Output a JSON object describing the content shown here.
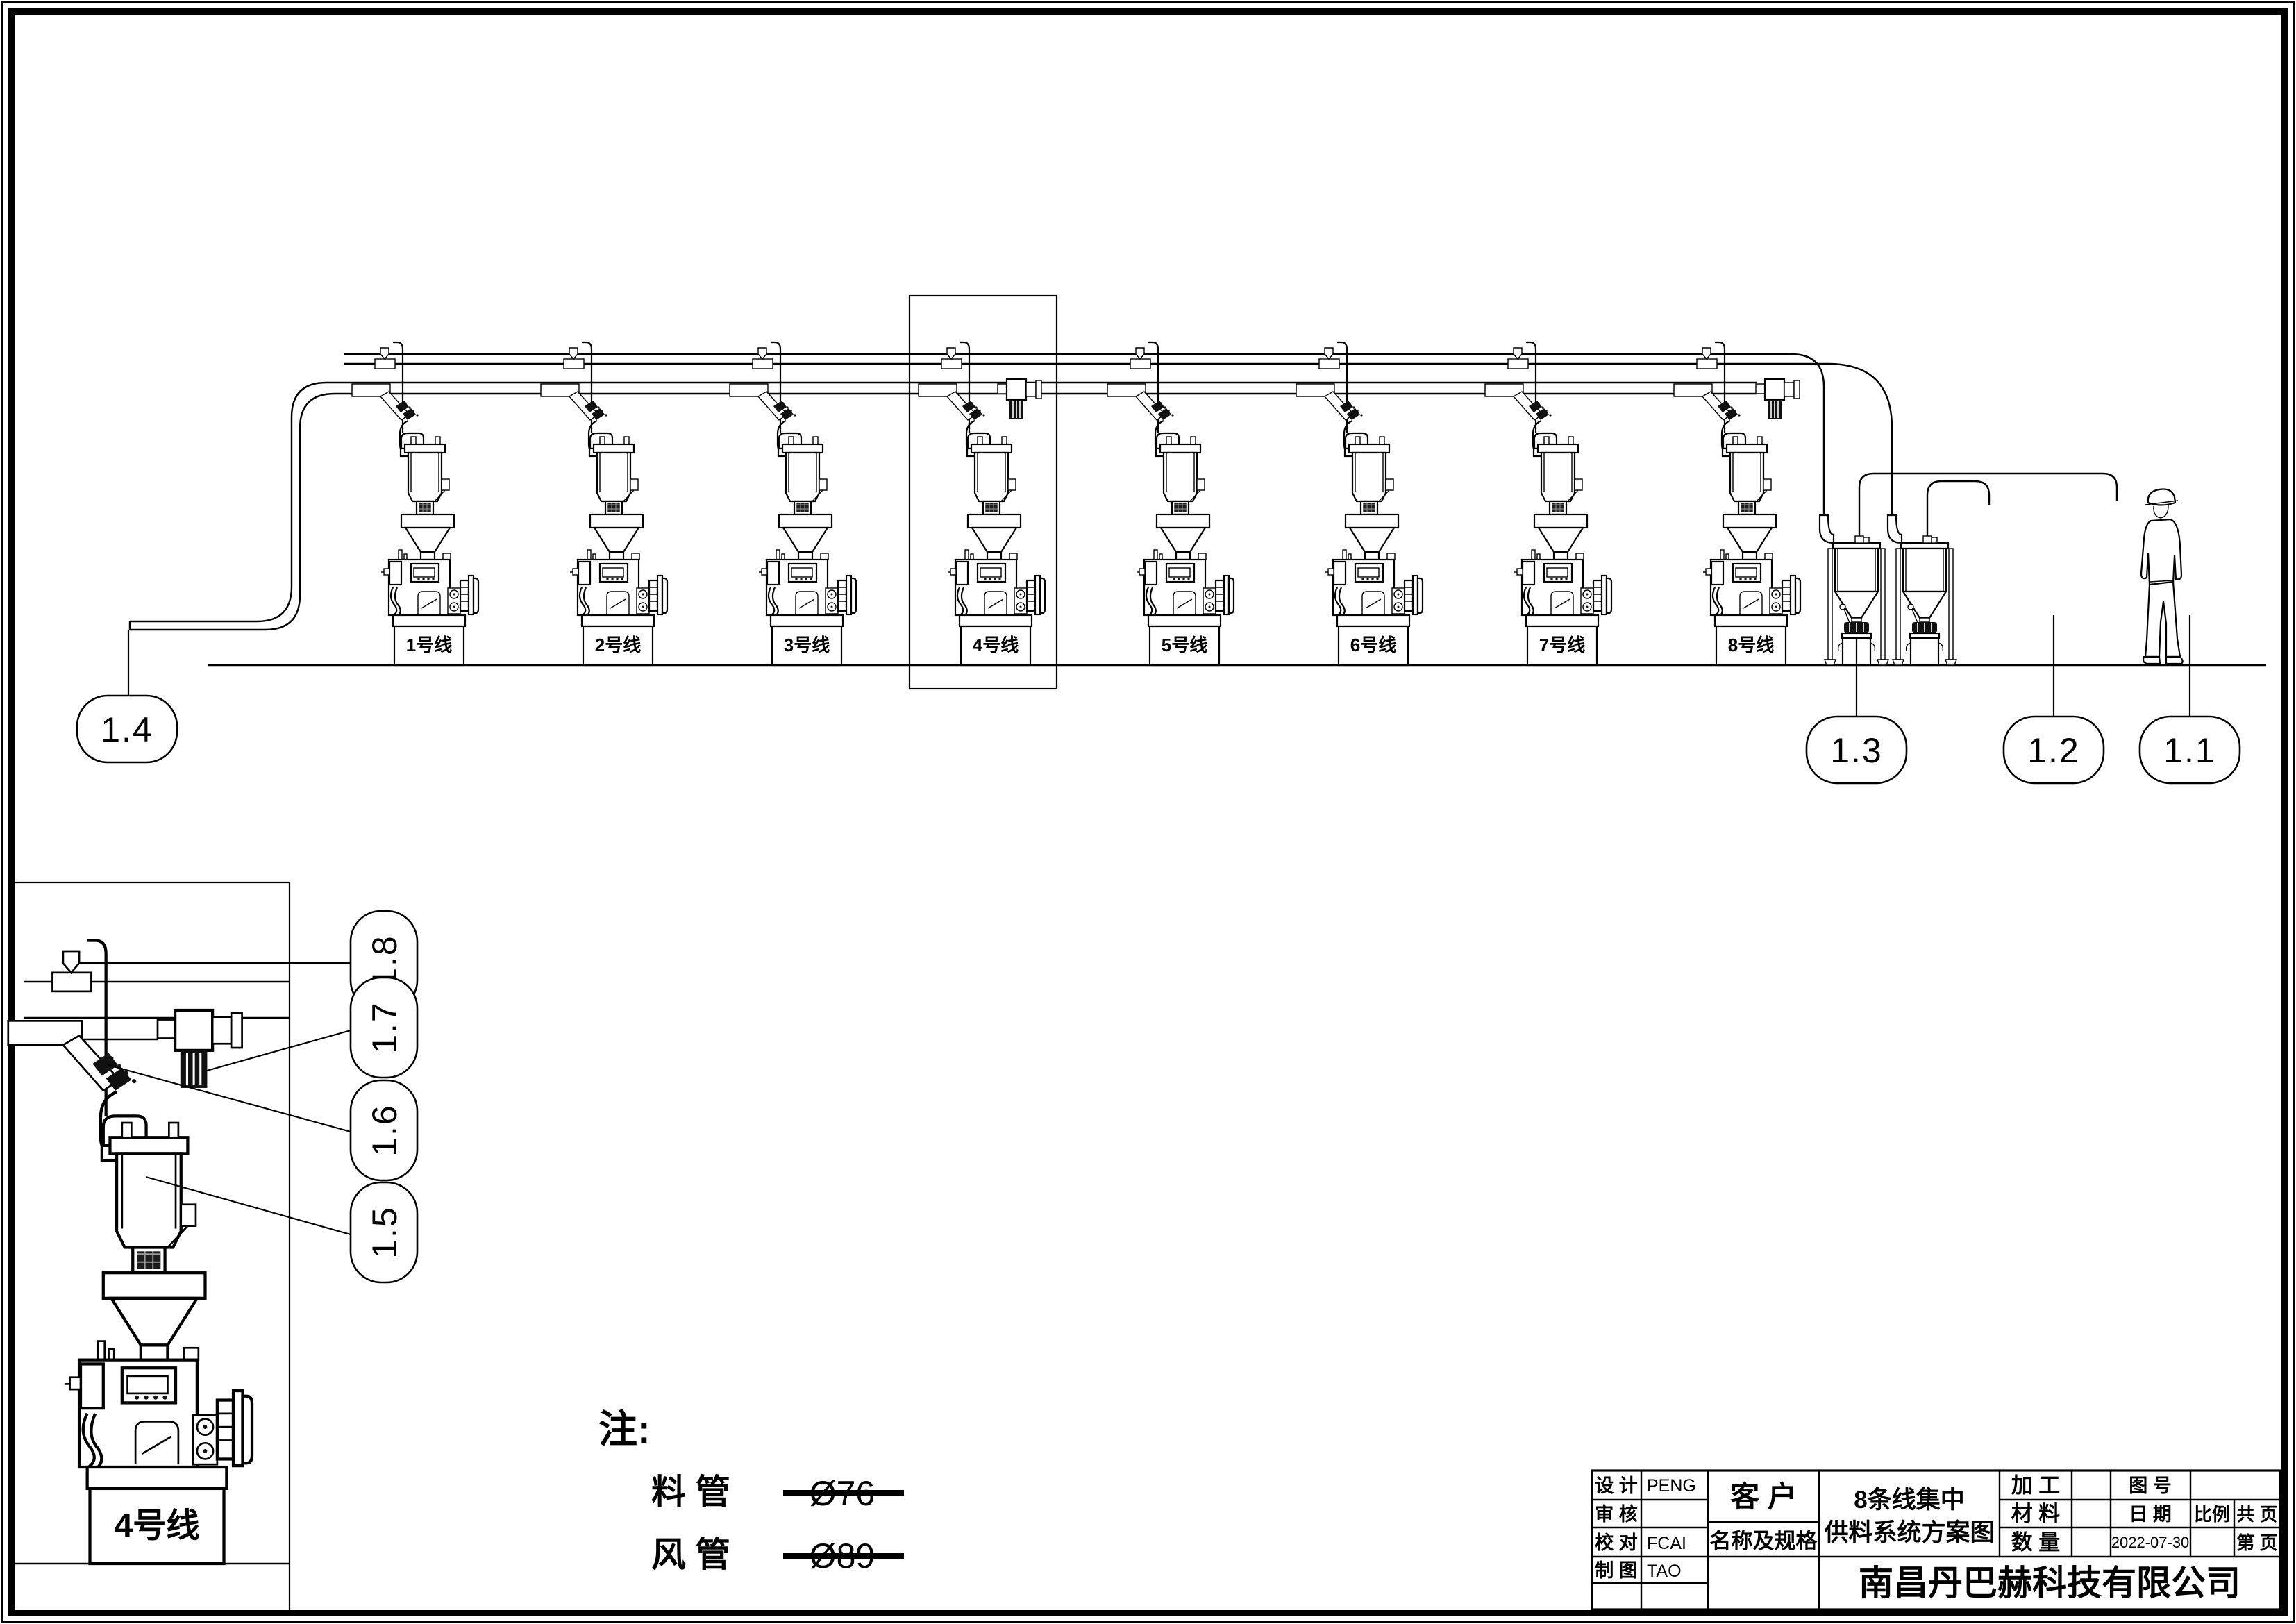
{
  "page": {
    "paper_color": "#ffffff",
    "ink_color": "#000000"
  },
  "main_view": {
    "machines": [
      {
        "label": "1号线"
      },
      {
        "label": "2号线"
      },
      {
        "label": "3号线"
      },
      {
        "label": "4号线"
      },
      {
        "label": "5号线"
      },
      {
        "label": "6号线"
      },
      {
        "label": "7号线"
      },
      {
        "label": "8号线"
      }
    ],
    "callouts": [
      {
        "label": "1.4"
      },
      {
        "label": "1.3"
      },
      {
        "label": "1.2"
      },
      {
        "label": "1.1"
      }
    ]
  },
  "detail_view": {
    "machine_label": "4号线",
    "callouts": [
      {
        "label": "1.8"
      },
      {
        "label": "1.7"
      },
      {
        "label": "1.6"
      },
      {
        "label": "1.5"
      }
    ]
  },
  "notes": {
    "heading": "注:",
    "rows": [
      {
        "name": "料 管",
        "spec": "Ø76"
      },
      {
        "name": "风 管",
        "spec": "Ø89"
      }
    ]
  },
  "title_block": {
    "design_label": "设 计",
    "design_value": "PENG",
    "review_label": "审 核",
    "review_value": "",
    "check_label": "校 对",
    "check_value": "FCAI",
    "draft_label": "制 图",
    "draft_value": "TAO",
    "customer_label": "客 户",
    "spec_label": "名称及规格",
    "title_line1": "8条线集中",
    "title_line2": "供料系统方案图",
    "process_label": "加 工",
    "material_label": "材 料",
    "quantity_label": "数 量",
    "drawing_no_label": "图 号",
    "date_label": "日 期",
    "date_value": "2022-07-30",
    "scale_label": "比例",
    "total_pages_label": "共  页",
    "page_label": "第  页",
    "company": "南昌丹巴赫科技有限公司"
  }
}
